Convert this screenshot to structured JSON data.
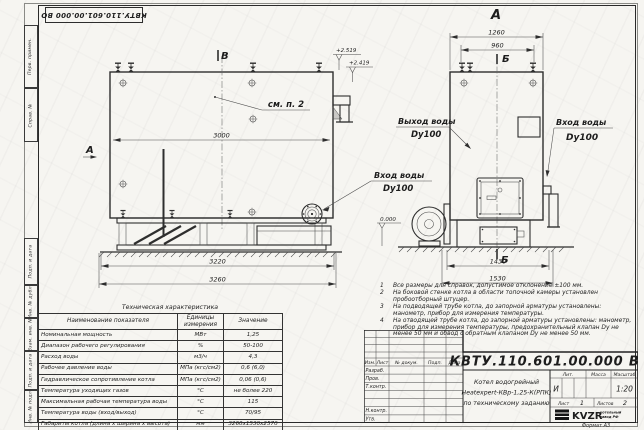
{
  "sheet": {
    "stamp_top_left": "КВТУ.110.601.00.000 ВО",
    "format_label": "Формат А3",
    "margin_labels": [
      "Перв. примен.",
      "Справ. №",
      "Подп. и дата",
      "Инв. № дубл.",
      "Взам. инв. №",
      "Подп. и дата",
      "Инв. № подл."
    ]
  },
  "drawing": {
    "side_view": {
      "section_mark": "В",
      "view_mark": "А",
      "callout_note": "см. п. 2",
      "dims": {
        "inner_length": "3000",
        "frame_length": "3220",
        "overall_length": "3260"
      },
      "elevations": {
        "upper": "+2.519",
        "lower": "+2.419"
      },
      "inlet": {
        "label": "Вход воды",
        "dn": "Dy100"
      }
    },
    "front_view": {
      "view_title": "А",
      "section_mark": "Б",
      "zero_level": "0.000",
      "dims": {
        "overall_width": "1260",
        "fitting_spacing": "960",
        "base_width": "1430",
        "overall_base_width": "1530"
      },
      "outlet": {
        "label": "Выход воды",
        "dn": "Dy100"
      },
      "inlet": {
        "label": "Вход воды",
        "dn": "Dy100"
      }
    }
  },
  "tech_table": {
    "title": "Техническая характеристика",
    "headers": [
      "Наименование показателя",
      "Единицы измерения",
      "Значение"
    ],
    "rows": [
      [
        "Номинальная мощность",
        "МВт",
        "1,25"
      ],
      [
        "Диапазон рабочего регулирования",
        "%",
        "50-100"
      ],
      [
        "Расход воды",
        "м3/ч",
        "4,3"
      ],
      [
        "Рабочее давление воды",
        "МПа (кгс/см2)",
        "0,6 (6,0)"
      ],
      [
        "Гидравлическое сопротивление котла",
        "МПа (кгс/см2)",
        "0,06 (0,6)"
      ],
      [
        "Температура уходящих газов",
        "°С",
        "не более 220"
      ],
      [
        "Максимальная рабочая температура воды",
        "°С",
        "115"
      ],
      [
        "Температура воды (вход/выход)",
        "°С",
        "70/95"
      ],
      [
        "Габариты котла (длина х ширина х высота)",
        "мм",
        "3260х1530х2570"
      ]
    ]
  },
  "notes": {
    "items": [
      {
        "n": "1",
        "text": "Все размеры для справок, допустимое отклонение ±100 мм."
      },
      {
        "n": "2",
        "text": "На боковой стенке котла в области топочной камеры установлен пробоотборный штуцер."
      },
      {
        "n": "3",
        "text": "На подводящей трубе котла, до запорной арматуры установлены: манометр, прибор для измерения температуры."
      },
      {
        "n": "4",
        "text": "На отводящей трубе котла, до запорной арматуры установлены: манометр, прибор для измерения температуры, предохранительный клапан Dу не менее 50 мм и обвод с обратным клапаном Dу не менее 50 мм."
      }
    ]
  },
  "title_block": {
    "designation": "КВТУ.110.601.00.000 ВО",
    "header_cols": [
      "Изм.",
      "Лист",
      "№ докум.",
      "Подп.",
      "Дата"
    ],
    "row_labels": [
      "Разраб.",
      "Пров.",
      "Т.контр.",
      "Н.контр.",
      "Утв."
    ],
    "name_line1": "Котел водогрейный",
    "name_line2": "Heatexpert-КВр-1,25-К(РПК)",
    "name_line3": "по техническому заданию",
    "lit_header": "Лит.",
    "mass_header": "Масса",
    "scale_header": "Масштаб",
    "lit_value": "И",
    "scale_value": "1:20",
    "sheet_label": "Лист",
    "sheet_value": "1",
    "sheets_label": "Листов",
    "sheets_value": "2",
    "logo_text": "KVZR",
    "logo_caption1": "котельный",
    "logo_caption2": "завод РФ"
  }
}
